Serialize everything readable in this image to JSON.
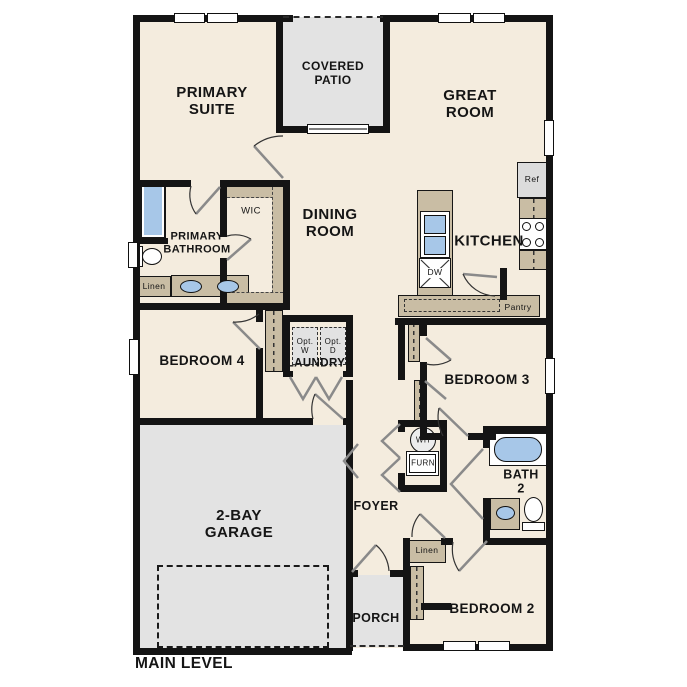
{
  "colors": {
    "wall": "#141414",
    "interior": "#f4ecde",
    "outdoor_gray": "#e3e3e3",
    "casework_tan": "#c9bda4",
    "fixture_blue": "#a7c7e8"
  },
  "rooms": {
    "primary_suite": {
      "label": "PRIMARY\nSUITE"
    },
    "covered_patio": {
      "label": "COVERED\nPATIO"
    },
    "great_room": {
      "label": "GREAT\nROOM"
    },
    "dining_room": {
      "label": "DINING\nROOM"
    },
    "kitchen": {
      "label": "KITCHEN"
    },
    "primary_bathroom": {
      "label": "PRIMARY\nBATHROOM"
    },
    "wic": {
      "label": "WIC"
    },
    "bedroom_4": {
      "label": "BEDROOM 4"
    },
    "laundry": {
      "label": "LAUNDRY"
    },
    "bedroom_3": {
      "label": "BEDROOM 3"
    },
    "foyer": {
      "label": "FOYER"
    },
    "bath_2": {
      "label": "BATH\n2"
    },
    "bedroom_2": {
      "label": "BEDROOM 2"
    },
    "porch": {
      "label": "PORCH"
    },
    "garage": {
      "label": "2-BAY\nGARAGE"
    }
  },
  "fixtures": {
    "refrigerator": "Ref",
    "dishwasher": "DW",
    "pantry": "Pantry",
    "linen_bathroom": "Linen",
    "linen_hall": "Linen",
    "optional_washer": "Opt.\nW",
    "optional_dryer": "Opt.\nD",
    "water_heater": "WH",
    "furnace": "FURN"
  },
  "footer": {
    "level_label": "MAIN LEVEL"
  }
}
